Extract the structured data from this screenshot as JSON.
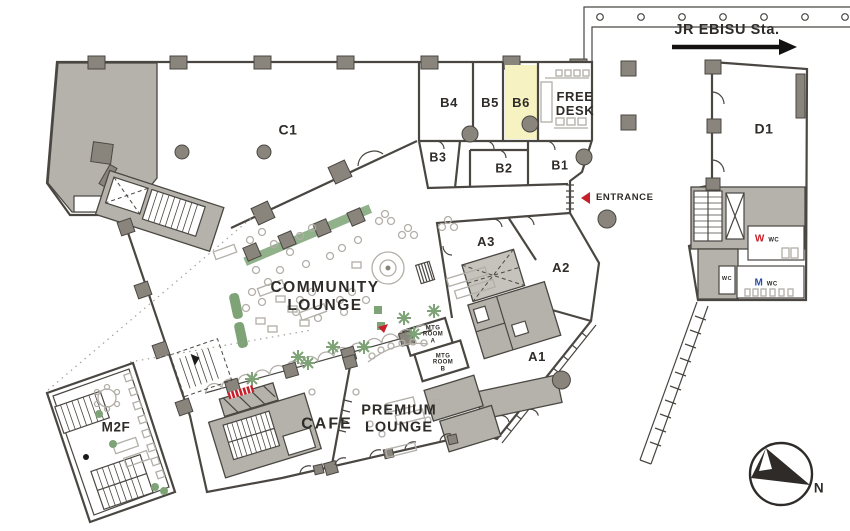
{
  "colors": {
    "wall": "#4a4742",
    "ink": "#2e2b28",
    "gray": "#b5b1ab",
    "column": "#8a857c",
    "light": "#b2aea8",
    "green": "#7ea377",
    "red": "#c8202a",
    "blue": "#2b4fa0",
    "yellow": "#f6f2c2"
  },
  "station": {
    "label": "JR EBISU Sta."
  },
  "entrance": {
    "label": "ENTRANCE"
  },
  "compass": {
    "north_label": "N"
  },
  "highlight": {
    "room": "B6",
    "color": "#f6f2c2"
  },
  "rooms": {
    "c1": "C1",
    "d1": "D1",
    "m2f": "M2F",
    "b1": "B1",
    "b2": "B2",
    "b3": "B3",
    "b4": "B4",
    "b5": "B5",
    "b6": "B6",
    "a1": "A1",
    "a2": "A2",
    "a3": "A3"
  },
  "areas": {
    "free_desk": {
      "line1": "FREE",
      "line2": "DESK"
    },
    "community_lounge": {
      "line1": "COMMUNITY",
      "line2": "LOUNGE"
    },
    "premium_lounge": {
      "line1": "PREMIUM",
      "line2": "LOUNGE"
    },
    "cafe": "CAFE",
    "mtg_room_a": {
      "line1": "MTG",
      "line2": "ROOM",
      "line3": "A"
    },
    "mtg_room_b": {
      "line1": "MTG",
      "line2": "ROOM",
      "line3": "B"
    }
  },
  "restrooms": {
    "women": {
      "letter": "W",
      "label": "WC"
    },
    "men": {
      "letter": "M",
      "label": "WC"
    },
    "unisex": "WC"
  }
}
